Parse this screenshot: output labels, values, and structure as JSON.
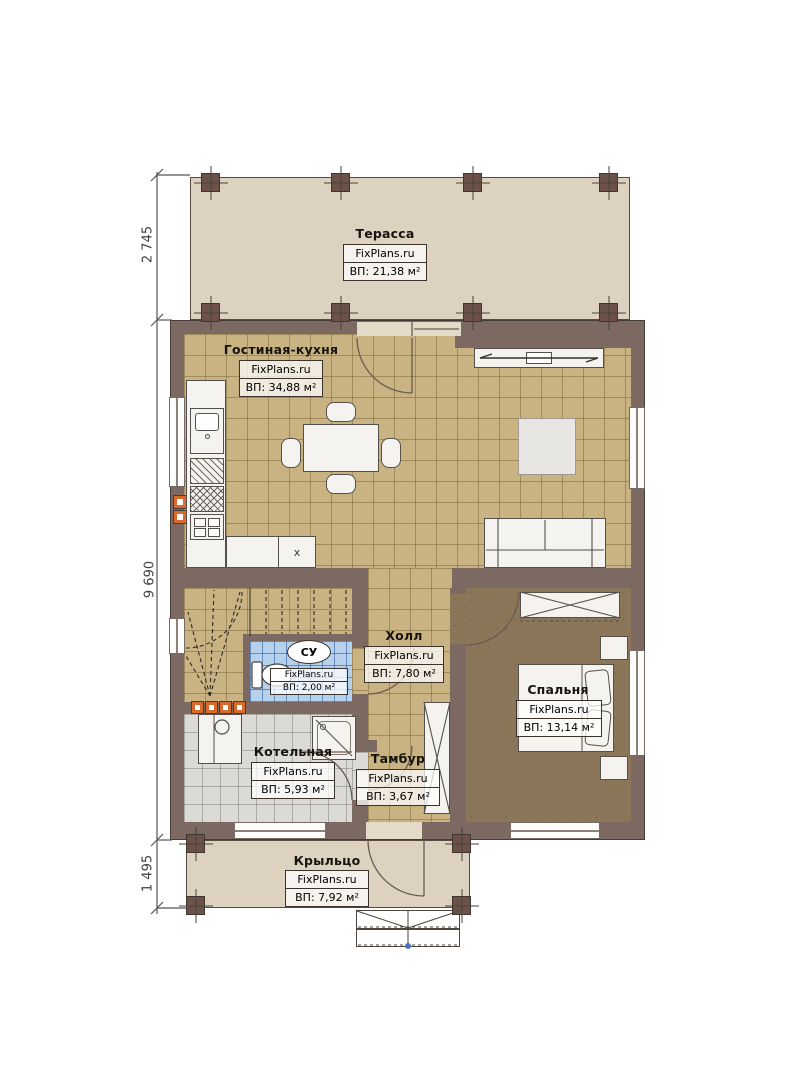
{
  "plan": {
    "brand": "FixPlans.ru",
    "rooms": [
      {
        "name": "Терасса",
        "area": "ВП: 21,38 м²"
      },
      {
        "name": "Гостиная-кухня",
        "area": "ВП: 34,88 м²"
      },
      {
        "name": "Холл",
        "area": "ВП: 7,80 м²"
      },
      {
        "name": "СУ",
        "area": "ВП: 2,00 м²"
      },
      {
        "name": "Спальня",
        "area": "ВП: 13,14 м²"
      },
      {
        "name": "Котельная",
        "area": "ВП: 5,93 м²"
      },
      {
        "name": "Тамбур",
        "area": "ВП: 3,67 м²"
      },
      {
        "name": "Крыльцо",
        "area": "ВП: 7,92 м²"
      }
    ],
    "dimensions": {
      "terrace_depth": "2 745",
      "house_depth": "9 690",
      "porch_depth": "1 495"
    },
    "kitchen_cabinet_mark": "x",
    "colors": {
      "wall": "#7b6962",
      "terrace_floor": "#ddd2bf",
      "living_tile": "#c9b383",
      "boiler_tile": "#dbdad7",
      "bath_tile": "#b5d1ec",
      "bedroom_floor": "#8c7659",
      "marker_orange": "#d96a2c",
      "step_marker_blue": "#4a72c4"
    }
  }
}
